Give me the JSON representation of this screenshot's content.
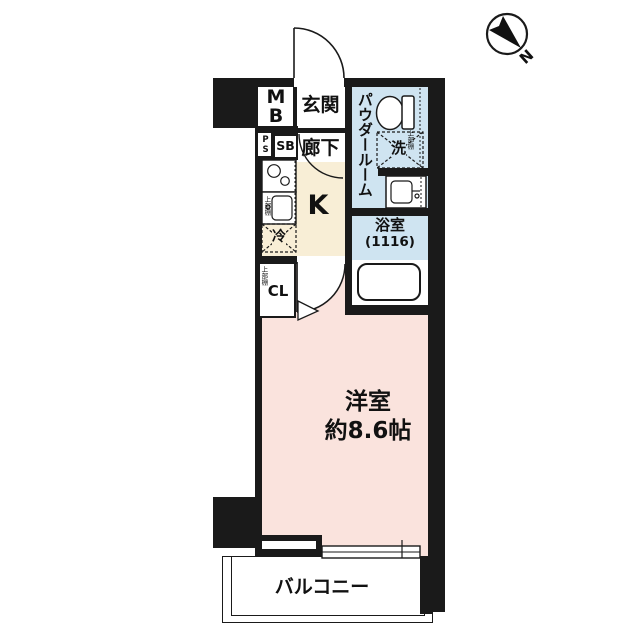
{
  "compass": {
    "north_label": "N"
  },
  "colors": {
    "wall": "#1a1a1a",
    "wet": "#cfe4f1",
    "kitchen": "#f8eed6",
    "room": "#fae3dd"
  },
  "rooms": {
    "mb": {
      "label": "MB"
    },
    "entrance": {
      "label": "玄関"
    },
    "ps": {
      "label": "PS"
    },
    "sb": {
      "label": "SB"
    },
    "corridor": {
      "label": "廊下"
    },
    "powder_room": {
      "label": "パウダールーム",
      "shelf_note": "上部棚"
    },
    "washer": {
      "label": "洗"
    },
    "kitchen": {
      "label": "K",
      "shelf_note": "上部棚"
    },
    "fridge": {
      "label": "冷"
    },
    "closet": {
      "label": "CL",
      "shelf_note": "上部棚"
    },
    "bathroom": {
      "label": "浴室",
      "size_note": "(1116)"
    },
    "main_room": {
      "label": "洋室",
      "size_note": "約8.6帖"
    },
    "balcony": {
      "label": "バルコニー"
    }
  }
}
